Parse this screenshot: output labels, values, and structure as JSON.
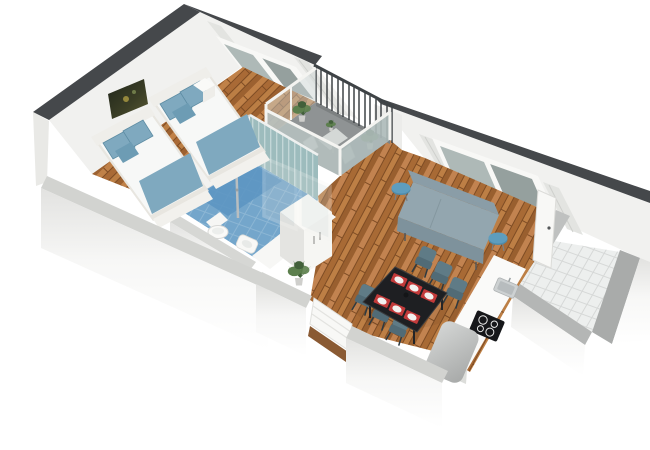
{
  "scene": {
    "title": "3D isometric floor plan rendering of a one-bedroom apartment",
    "view": "axonometric cutaway, white background",
    "rooms": [
      {
        "name": "bedroom",
        "items": [
          "double-bed",
          "double-bed",
          "blue-pillows",
          "nightstand",
          "wall-art",
          "window-with-curtains",
          "wood-floor"
        ]
      },
      {
        "name": "bathroom",
        "items": [
          "blue-tile-floor",
          "shower-column",
          "toilet",
          "bidet",
          "washbasin-counter",
          "striped-glass-wall"
        ]
      },
      {
        "name": "hallway",
        "items": [
          "wood-floor",
          "glazed-partition",
          "wardrobe-cabinet"
        ]
      },
      {
        "name": "balcony",
        "items": [
          "gray-deck",
          "metal-railing",
          "glass-balustrade",
          "bistro-table",
          "two-chairs",
          "potted-plants"
        ]
      },
      {
        "name": "living-room",
        "items": [
          "sofa",
          "two-blue-side-tables",
          "window-with-curtains",
          "dining-table",
          "six-chairs",
          "red-placemats-with-plates",
          "open-door",
          "wood-floor"
        ]
      },
      {
        "name": "kitchen",
        "items": [
          "white-counter",
          "steel-sink",
          "black-cooktop",
          "gray-appliance",
          "white-tile-floor"
        ]
      },
      {
        "name": "entrance",
        "items": [
          "front-door",
          "potted-plant"
        ]
      }
    ]
  },
  "colors": {
    "cap_dark": "#45484b",
    "wall_face": "#f1f1ef",
    "wall_top": "#d2d3d0",
    "glass": "#aeb9b7",
    "glass_dark": "#95a09e",
    "wood_base": "#b5763f",
    "tile_blue": "#74a6cb",
    "tile_blue_deep": "#5d96c2",
    "balcony_floor": "#8f9394",
    "railing_dark": "#3e4346",
    "furn_white": "#f6f6f4",
    "bed_blue": "#7fa9bf",
    "sofa": "#93a6af",
    "stool_blue": "#5e9dbe",
    "chair_slate": "#5f7b86",
    "table_black": "#1e1f22",
    "placemat_red": "#c23a3a",
    "plate_white": "#f1f1ef",
    "plant_green": "#5c7f4d",
    "plant_green_dark": "#42603a",
    "counter_white": "#fafaf9",
    "cooktop_black": "#16171a",
    "appliance_gray": "#b5b7b6",
    "tile_white": "#edefee",
    "door_white": "#f8f8f6",
    "threshold_brown": "#8a5a33"
  }
}
